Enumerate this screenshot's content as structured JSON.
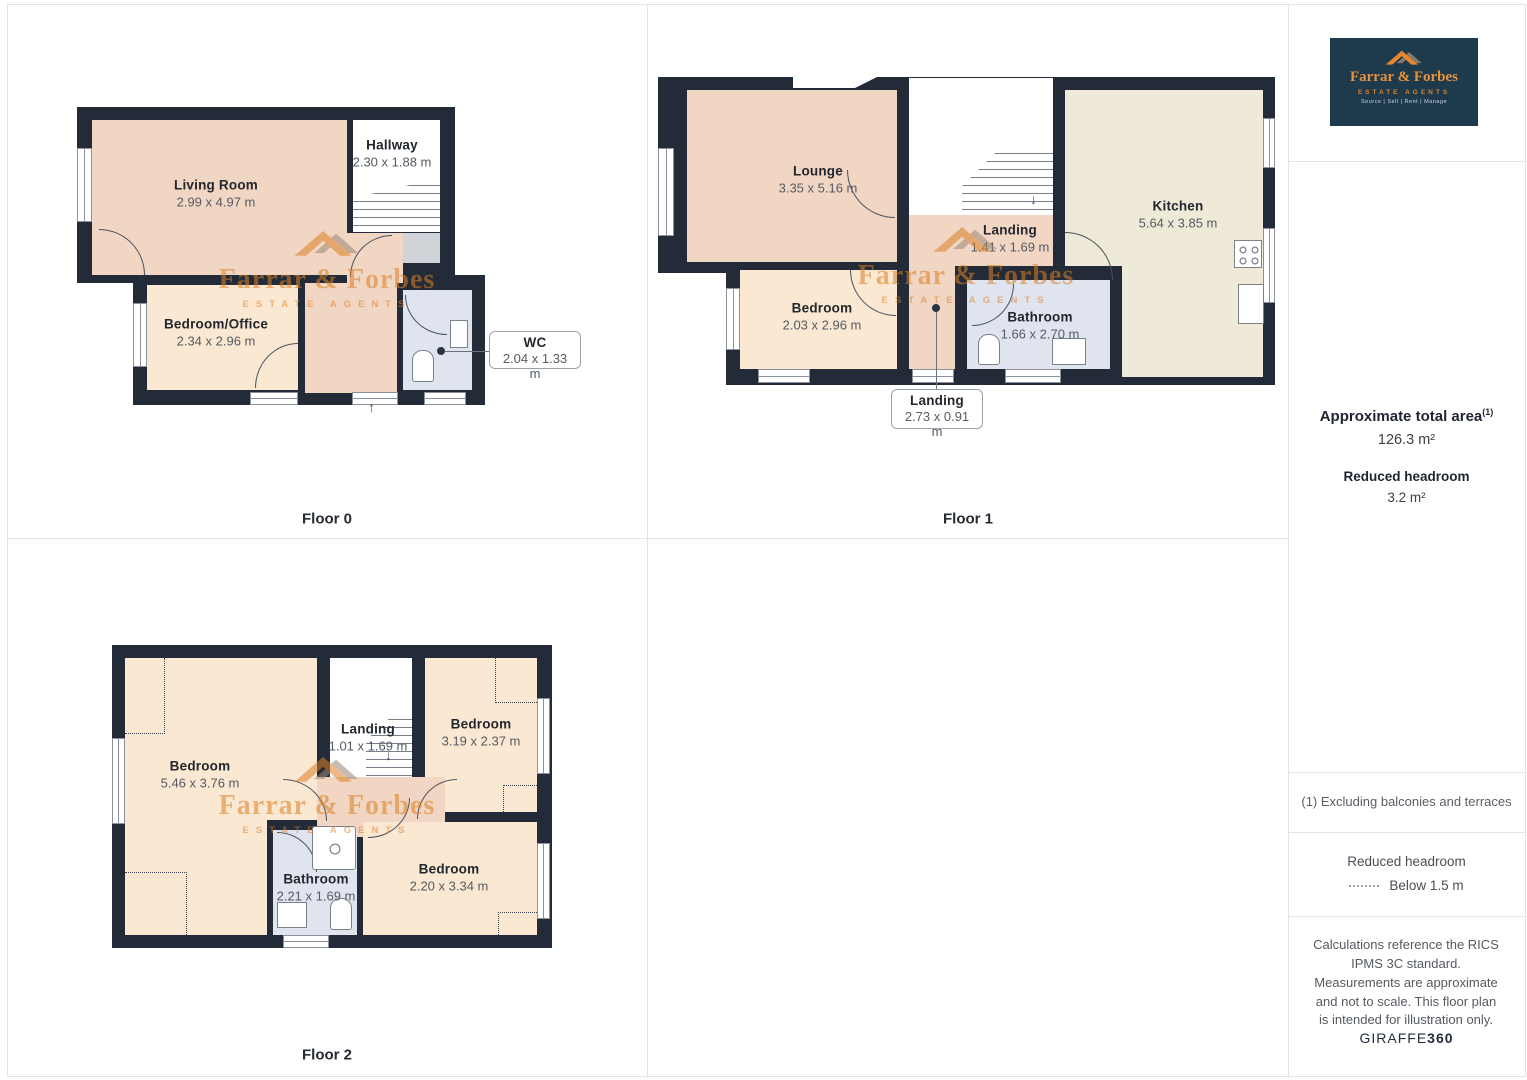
{
  "floors": [
    {
      "label": "Floor 0",
      "rooms": [
        {
          "name": "Living Room",
          "dims": "2.99 x 4.97 m"
        },
        {
          "name": "Hallway",
          "dims": "2.30 x 1.88 m"
        },
        {
          "name": "Bedroom/Office",
          "dims": "2.34 x 2.96 m"
        },
        {
          "name": "WC",
          "dims": "2.04 x 1.33 m"
        }
      ]
    },
    {
      "label": "Floor 1",
      "rooms": [
        {
          "name": "Lounge",
          "dims": "3.35 x 5.16 m"
        },
        {
          "name": "Landing",
          "dims": "1.41 x 1.69 m"
        },
        {
          "name": "Kitchen",
          "dims": "5.64 x 3.85 m"
        },
        {
          "name": "Bedroom",
          "dims": "2.03 x 2.96 m"
        },
        {
          "name": "Bathroom",
          "dims": "1.66 x 2.70 m"
        },
        {
          "name": "Landing",
          "dims": "2.73 x 0.91 m"
        }
      ]
    },
    {
      "label": "Floor 2",
      "rooms": [
        {
          "name": "Bedroom",
          "dims": "5.46 x 3.76 m"
        },
        {
          "name": "Landing",
          "dims": "1.01 x 1.69 m"
        },
        {
          "name": "Bedroom",
          "dims": "3.19 x 2.37 m"
        },
        {
          "name": "Bathroom",
          "dims": "2.21 x 1.69 m"
        },
        {
          "name": "Bedroom",
          "dims": "2.20 x 3.34 m"
        }
      ]
    }
  ],
  "watermark": {
    "line1": "Farrar & Forbes",
    "line2": "ESTATE AGENTS"
  },
  "sidebar": {
    "logo": {
      "name": "Farrar & Forbes",
      "tagline": "ESTATE AGENTS",
      "services": "Source | Sell | Rent | Manage"
    },
    "total_area_label": "Approximate total area",
    "total_area_sup": "(1)",
    "total_area_value": "126.3 m²",
    "reduced_headroom_label": "Reduced headroom",
    "reduced_headroom_value": "3.2 m²",
    "footnote": "(1) Excluding balconies and terraces",
    "legend_title": "Reduced headroom",
    "legend_value": "Below 1.5 m",
    "disclaimer": "Calculations reference the RICS IPMS 3C standard. Measurements are approximate and not to scale. This floor plan is intended for illustration only.",
    "brand_giraffe": "GIRAFFE",
    "brand_360": "360"
  },
  "colors": {
    "accent_orange": "#dd8026",
    "wall": "#222b37",
    "room_salmon": "#f1d6c4",
    "room_peach": "#fbe8d2",
    "room_cream": "#eeead7",
    "room_bathroom": "#dfe4ef",
    "logo_background": "#1e3a4d"
  }
}
